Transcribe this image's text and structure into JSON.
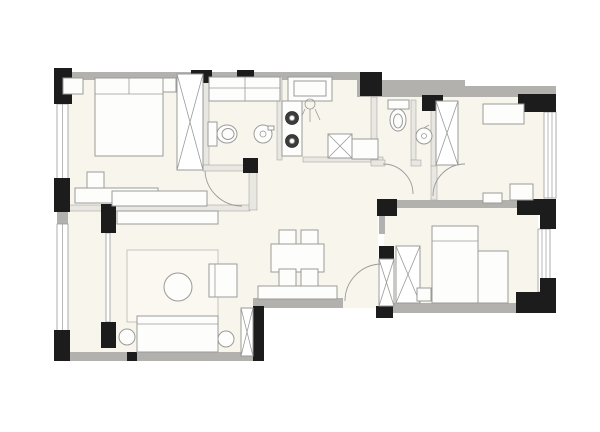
{
  "meta": {
    "kind": "floor-plan",
    "canvas_width": 600,
    "canvas_height": 432,
    "labels_visible": false
  },
  "palette": {
    "background": "#ffffff",
    "floor": "#f8f6ec",
    "exterior_wall": "#b3b1ad",
    "structural_pier": "#1c1c1c",
    "interior_wall": "#e9e7e2",
    "interior_wall_edge": "#a8a6a2",
    "drawing_line": "#9a9a9a",
    "furniture_fill": "#fdfdfb",
    "rug_fill": "#faf8f1"
  },
  "rooms": [
    {
      "name": "bedroom-1",
      "position": "top-left"
    },
    {
      "name": "bathroom-1",
      "position": "top-center-left"
    },
    {
      "name": "kitchen",
      "position": "top-center"
    },
    {
      "name": "bathroom-2",
      "position": "top-center-right"
    },
    {
      "name": "study-bedroom-3",
      "position": "top-right"
    },
    {
      "name": "living-room",
      "position": "bottom-left"
    },
    {
      "name": "dining-area",
      "position": "bottom-center"
    },
    {
      "name": "bedroom-2",
      "position": "bottom-right"
    },
    {
      "name": "balcony",
      "position": "left"
    }
  ],
  "fixtures": [
    "double-bed",
    "nightstand",
    "wardrobe",
    "sliding-door",
    "tv-cabinet",
    "rug",
    "coffee-table",
    "sofa",
    "armchair",
    "side-table",
    "dining-table",
    "dining-chair",
    "sideboard",
    "kitchen-sink",
    "cooktop-two-burners",
    "refrigerator",
    "toilet",
    "wash-basin",
    "single-bed",
    "desk",
    "door-swing-arc",
    "window-band"
  ]
}
